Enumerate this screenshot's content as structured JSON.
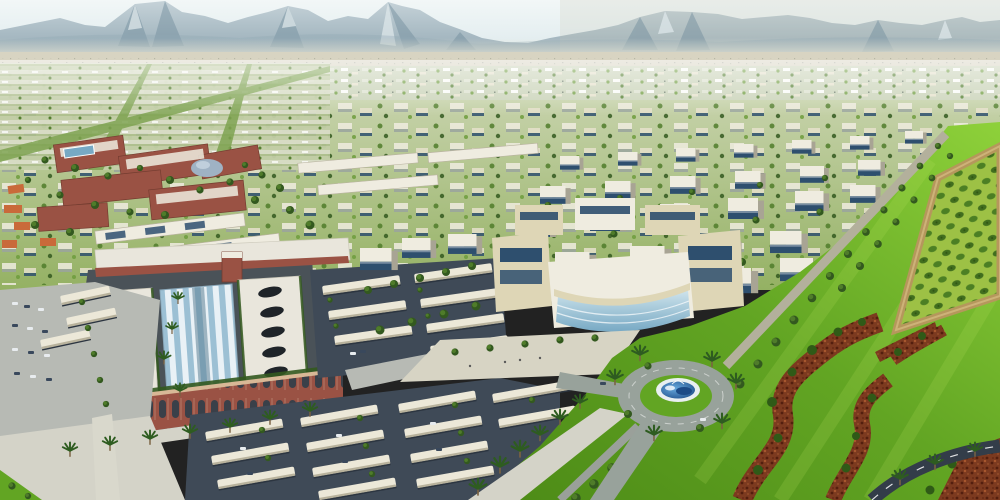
{
  "scene": {
    "title": "Aerial rendering of a master-planned desert city with mountain backdrop",
    "regions": [
      {
        "id": "sky",
        "description": "Pale hazy desert sky"
      },
      {
        "id": "mountain-range",
        "description": "Jagged gray-blue desert mountain range across the horizon"
      },
      {
        "id": "desert-flats",
        "description": "Pale sandy desert strip at the mountain base"
      },
      {
        "id": "distant-city",
        "description": "Hazy speckled band of distant low-rise city blocks and greenery"
      },
      {
        "id": "left-residential-grid",
        "description": "Gridded residential district with green tree-lined avenues"
      },
      {
        "id": "office-district",
        "description": "Rows of white mid-rise office blocks with dark glazing"
      },
      {
        "id": "university-campus",
        "description": "Red-brick campus buildings with white roofs, dome and rooftop pool"
      },
      {
        "id": "shopping-mall",
        "description": "Large mall with white slab roofs, oval skylights and glass barrel vault"
      },
      {
        "id": "mall-facade",
        "description": "Arched red-brick mall facade with rooftop hedge"
      },
      {
        "id": "parking-lots",
        "description": "Asphalt parking lots with rows of white shade canopies and cars"
      },
      {
        "id": "central-office-building",
        "description": "Curved blue-glass headquarters building with plaza"
      },
      {
        "id": "landscaped-park",
        "description": "Bright green lawn park on the right side"
      },
      {
        "id": "orchard-plot",
        "description": "Tan-bordered orchard plot with rows of shrubs"
      },
      {
        "id": "flowerbed-ribbons",
        "description": "Winding red-brown flowerbed ribbons in the lawn"
      },
      {
        "id": "roundabout-fountain",
        "description": "Traffic roundabout with elliptical blue fountain pool"
      },
      {
        "id": "boulevards",
        "description": "Tree- and palm-lined boulevards and perimeter roads"
      }
    ]
  },
  "palette": {
    "sky1": "#f2f7f7",
    "sky2": "#dce9ec",
    "mtnLight": "#c5d2d8",
    "mtnMid": "#93a9b4",
    "mtnShadow": "#6f8b9b",
    "mtnSnow": "#dde7ea",
    "mtnTint": "#c8c7b6",
    "desert": "#d8d4c2",
    "haze": "#e4e3d4",
    "farBase": "#cbd4ba",
    "midBase1": "#c6d2aa",
    "midBase2": "#94b163",
    "avenueGreen": "#7ea351",
    "treeDark": "#33591f",
    "treeMid": "#4f7c2a",
    "treeLight": "#6d9c3c",
    "palmGreen": "#2e5c20",
    "bldgWhite": "#efece0",
    "bldgCream": "#ded6b6",
    "bldgShadow": "#a8a494",
    "glassDark": "#2e4f6e",
    "glassBlue": "#77a9c4",
    "glassPale": "#cfe4ec",
    "brick": "#9a5244",
    "brickDark": "#743c30",
    "archDark": "#2f3e4a",
    "cornice": "#d8b896",
    "mallRoof": "#e9e6dc",
    "ovalDark": "#1f2429",
    "barrelA": "#e9f1f6",
    "barrelB": "#9cc0d4",
    "asphalt": "#3f4a57",
    "asphaltDark": "#333d49",
    "canopy": "#ece8d8",
    "canopyShade": "#b8b29c",
    "roadLight": "#d4d3c8",
    "roadMid": "#b7bab4",
    "ringRoad": "#98a29b",
    "lawnBright": "#8ed13a",
    "lawnMid": "#62a523",
    "lawnDark": "#4c8a16",
    "orchardFill": "#9dc145",
    "shrub": "#3c6a1c",
    "borderTan": "#b5975c",
    "flowerBase": "#7c3a1f",
    "flowerDark": "#541f0e",
    "flowerLight": "#a8582e",
    "fountainRim": "#e9eff1",
    "waterLight": "#66a8dc",
    "waterDark": "#1c4a86",
    "white": "#ffffff"
  }
}
